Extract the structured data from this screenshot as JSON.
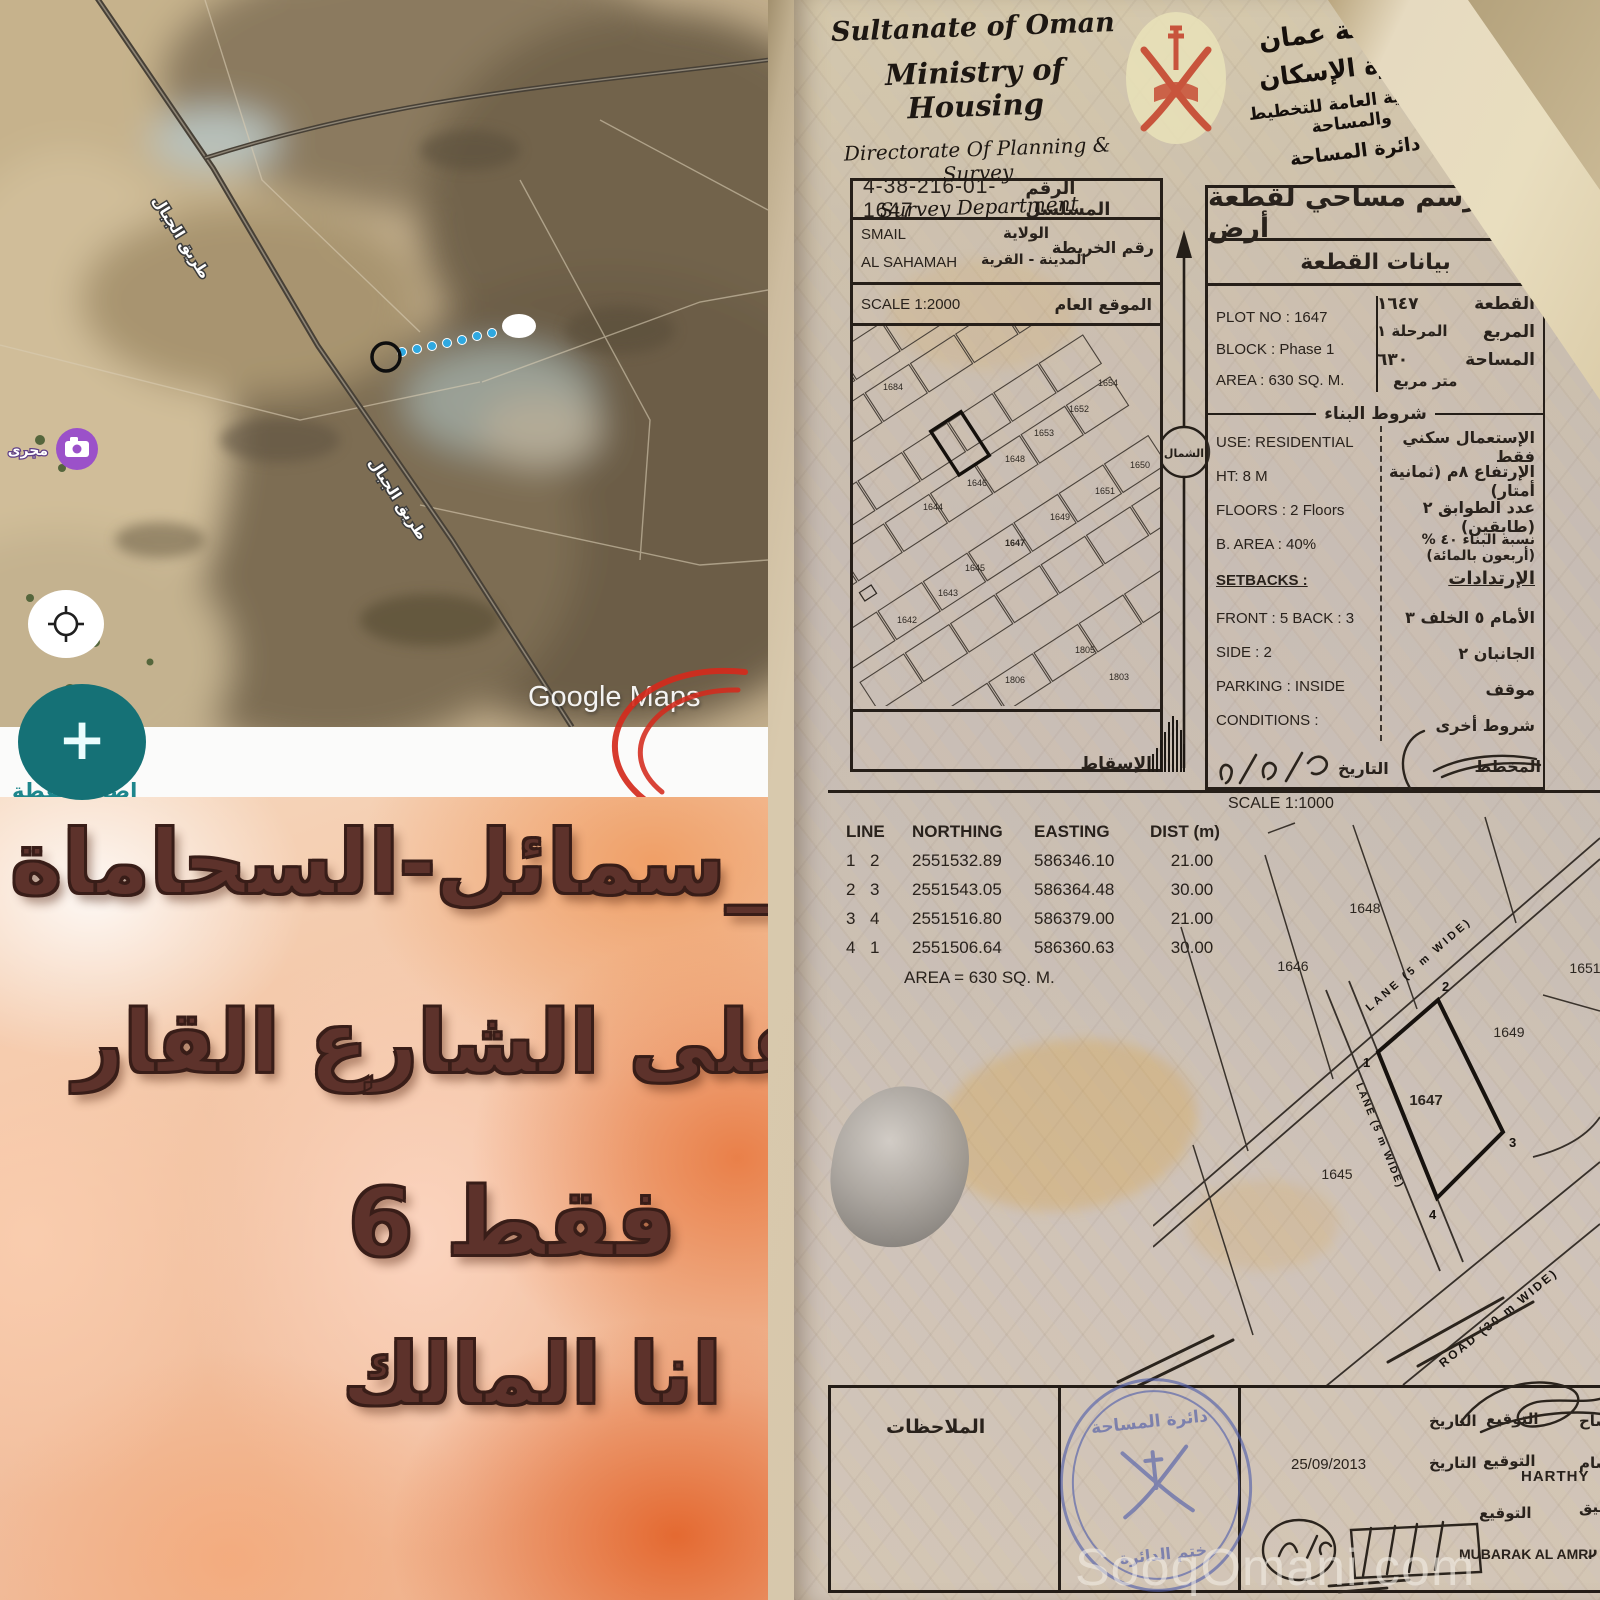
{
  "map": {
    "google_watermark": "Google Maps",
    "road_label": "طريق الجبال",
    "poi_label": "مجرى",
    "plus_label": "+",
    "add_point_label": "إضافة نقطة",
    "distance_label": "٤٩٠ متر"
  },
  "overlay": {
    "line1": "سمائل-السحاماة_",
    "line2": "على الشارع القار",
    "line3": "6 فقط",
    "line4": "انا المالك"
  },
  "watermark": "SooqOmani.com",
  "doc": {
    "header": {
      "country": "Sultanate of Oman",
      "ministry": "Ministry of Housing",
      "directorate": "Directorate Of Planning & Survey",
      "department": "Survey Department",
      "ar_line1": "سلطنة عمان",
      "ar_line2": "وزارة الإسكان",
      "ar_line3": "المديرية العامة للتخطيط والمساحة",
      "ar_line4": "دائرة المساحة"
    },
    "serial": {
      "number": "4-38-216-01-1647",
      "serial_label": "الرقم المسلسل",
      "wilayat_en": "SMAIL",
      "wilayat_label": "الولاية",
      "town_en": "AL SAHAMAH",
      "town_label": "المدينة - القرية",
      "map_no_label": "رقم الخريطة",
      "scale_label": "SCALE 1:2000",
      "location_label": "الموقع العام",
      "projection_label": "الإسقاط",
      "north_label": "الشمال"
    },
    "site_plan": {
      "plots": [
        "1684",
        "1654",
        "1652",
        "1653",
        "1648",
        "1646",
        "1644",
        "1650",
        "1651",
        "1649",
        "1647",
        "1645",
        "1643",
        "1642",
        "1805",
        "1806",
        "1803"
      ]
    },
    "plot": {
      "title": "رسم مساحي لقطعة أرض",
      "section_label": "بيانات القطعة",
      "plot_no_en": "PLOT NO : 1647",
      "block_en": "BLOCK :  Phase 1",
      "area_en": "AREA :  630 SQ. M.",
      "plot_label": "القطعة",
      "plot_value": "١٦٤٧",
      "block_label": "المربع",
      "block_value": "المرحلة ١",
      "area_label": "المساحة",
      "area_value": "٦٣٠",
      "area_unit": "متر مربع",
      "conditions_title": "شروط البناء",
      "use_en": "USE: RESIDENTIAL",
      "ht_en": "HT: 8 M",
      "floors_en": "FLOORS :  2 Floors",
      "barea_en": "B. AREA :    40%",
      "setbacks_en": "SETBACKS :",
      "front_back_en": "FRONT : 5      BACK : 3",
      "side_en": "SIDE :    2",
      "parking_en": "PARKING : INSIDE",
      "conditions_en": "CONDITIONS :",
      "use_ar": "الإستعمال   سكني فقط",
      "ht_ar": "الإرتفاع   ٨م   (ثمانية أمتار)",
      "floors_ar": "عدد الطوابق   ٢   (طابقين)",
      "barea_ar": "نسبة البناء  ٤٠ %  (أربعون بالمائة)",
      "setbacks_ar": "الإرتدادات",
      "front_back_ar": "الأمام  ٥      الخلف  ٣",
      "side_ar": "الجانبان          ٢",
      "parking_ar": "موقف",
      "other_ar": "شروط أخرى",
      "date_label": "التاريخ",
      "planner_label": "المخطط"
    },
    "coords": {
      "scale_label": "SCALE 1:1000",
      "col_line": "LINE",
      "col_northing": "NORTHING",
      "col_easting": "EASTING",
      "col_dist": "DIST (m)",
      "rows": [
        [
          "1",
          "2",
          "2551532.89",
          "586346.10",
          "21.00"
        ],
        [
          "2",
          "3",
          "2551543.05",
          "586364.48",
          "30.00"
        ],
        [
          "3",
          "4",
          "2551516.80",
          "586379.00",
          "21.00"
        ],
        [
          "4",
          "1",
          "2551506.64",
          "586360.63",
          "30.00"
        ]
      ],
      "area_line": "AREA = 630 SQ. M."
    },
    "detail_plan": {
      "plots": [
        "1648",
        "1646",
        "1651",
        "1649",
        "1647",
        "1645"
      ],
      "corners": [
        "1",
        "2",
        "3",
        "4"
      ],
      "lane_label": "LANE (5 m WIDE)",
      "road_label": "ROAD (30 m WIDE)"
    },
    "footer": {
      "notes_label": "الملاحظات",
      "stamp_top": "دائرة المساحة",
      "stamp_bottom": "ختم الدائرة",
      "date_label": "التاريخ",
      "sign_label": "التوقيع",
      "date_value": "25/09/2013",
      "name1": "HARTHY",
      "name2": "MUBARAK AL AMRI",
      "frag_surveyor": "ساح",
      "frag_draftsman": "سام",
      "frag_checker": "قيق",
      "frag_manager": "ر"
    }
  }
}
